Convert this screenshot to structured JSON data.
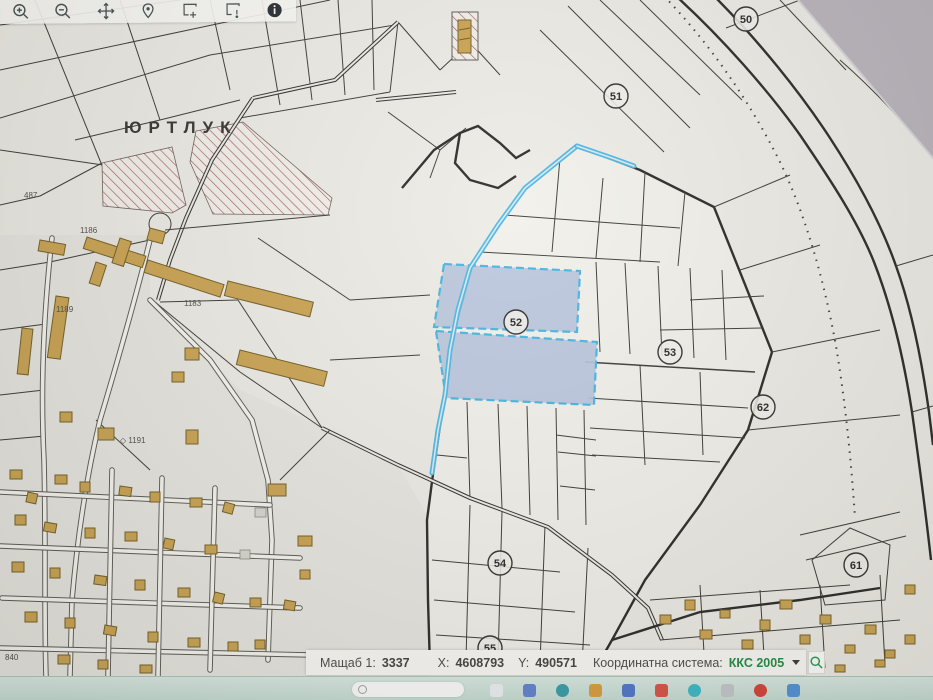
{
  "app": {
    "description": "Cadastral map viewer (photographed screen)"
  },
  "toolbar": {
    "icons": [
      {
        "name": "zoom-in-icon"
      },
      {
        "name": "zoom-out-icon"
      },
      {
        "name": "pan-icon"
      },
      {
        "name": "location-pin-icon"
      },
      {
        "name": "select-area-icon"
      },
      {
        "name": "area-info-icon"
      },
      {
        "name": "info-icon"
      }
    ]
  },
  "map": {
    "area_label": "ЮРТЛУК",
    "markers": [
      {
        "number": "50"
      },
      {
        "number": "51"
      },
      {
        "number": "52"
      },
      {
        "number": "53"
      },
      {
        "number": "54"
      },
      {
        "number": "55"
      },
      {
        "number": "61"
      },
      {
        "number": "62"
      }
    ],
    "small_labels": [
      {
        "text": "487"
      },
      {
        "text": "1186"
      },
      {
        "text": "1183"
      },
      {
        "text": "1189"
      },
      {
        "text": "◇ 1191"
      },
      {
        "text": "840"
      }
    ],
    "colors": {
      "background": "#edebe5",
      "selection_stroke": "#45b6e2",
      "selection_fill": "#b5c2db",
      "building": "#c9a14c",
      "hatch": "#a8505a"
    }
  },
  "status_bar": {
    "scale_label": "Мащаб 1:",
    "scale_value": "3337",
    "x_label": "X:",
    "x_value": "4608793",
    "y_label": "Y:",
    "y_value": "490571",
    "crs_label": "Координатна система:",
    "crs_value": "ККС 2005",
    "crs_color": "#168a3a",
    "search_icon": "search-icon"
  },
  "taskbar": {
    "icons": [
      {
        "name": "taskbar-search"
      },
      {
        "name": "app-icon-1"
      },
      {
        "name": "app-icon-2"
      },
      {
        "name": "app-icon-3"
      },
      {
        "name": "app-icon-4"
      },
      {
        "name": "app-icon-5"
      },
      {
        "name": "app-icon-6"
      },
      {
        "name": "app-icon-7"
      },
      {
        "name": "app-icon-8"
      },
      {
        "name": "app-icon-9"
      },
      {
        "name": "app-icon-10"
      }
    ]
  }
}
